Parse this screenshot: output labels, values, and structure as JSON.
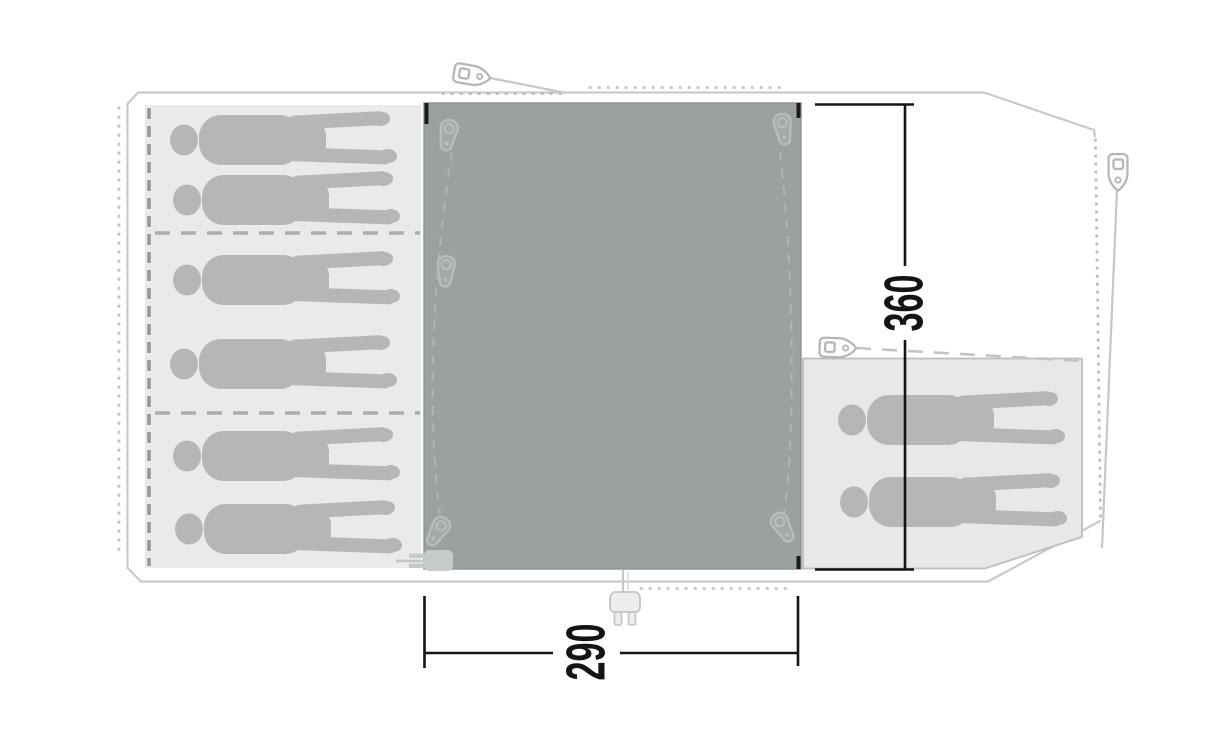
{
  "floorplan": {
    "type": "tent-floorplan-top-view",
    "dimensions": {
      "depth_label": "360",
      "width_label": "290"
    },
    "areas": {
      "sleeping_cabin_left": {
        "sleeper_silhouettes": 6,
        "compartments": 3
      },
      "living_room_center": {
        "sleeper_silhouettes": 0
      },
      "annex_right": {
        "sleeper_silhouettes": 2
      }
    },
    "icons": {
      "zipper_pulls_living_room": 5,
      "guyline_pegs": 3,
      "power_plug_entries": 2
    },
    "colors": {
      "living_room_fill": "#9aa1a0",
      "cabin_fill": "#e9eae9",
      "annex_fill": "#e7e8e7",
      "silhouette_fill": "#b4b7b6",
      "outline_stroke": "#c9cbca",
      "dimension_ink": "#141414"
    }
  }
}
